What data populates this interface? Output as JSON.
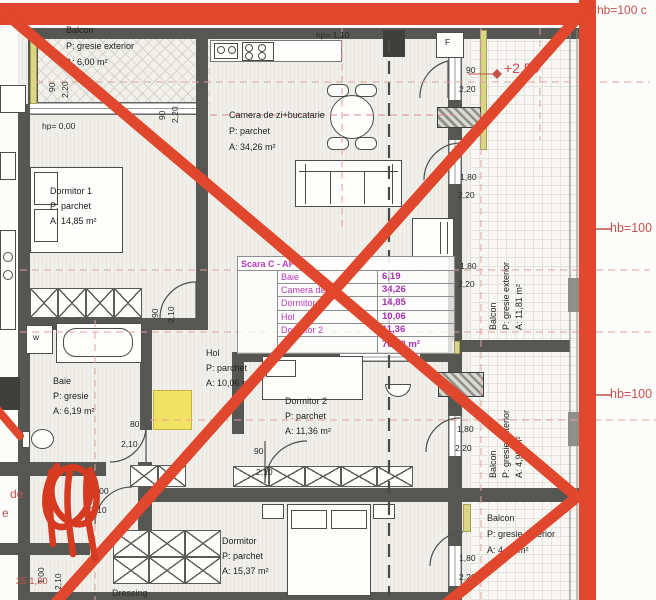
{
  "annotations": {
    "hb_top": "hb=100 c",
    "hb_mid": "hb=100",
    "hb_low": "hb=100",
    "level": "+2,50",
    "dim_red": "25  1,80",
    "frag1": "de",
    "frag2": "e"
  },
  "labels": {
    "hp_balcony": "hp= 0,00",
    "hp_kitchen": "hp= 1,10",
    "washer": "w",
    "fridge": "F",
    "dressing": "Dressing"
  },
  "rooms": {
    "balcon_tl": {
      "name": "Balcon",
      "floor": "P: gresie exterior",
      "area": "A: 6,00 m²"
    },
    "living": {
      "name": "Camera de zi+bucatarie",
      "floor": "P: parchet",
      "area": "A: 34,26 m²"
    },
    "dormitor1": {
      "name": "Dormitor 1",
      "floor": "P: parchet",
      "area": "A: 14,85 m²"
    },
    "baie": {
      "name": "Baie",
      "floor": "P: gresie",
      "area": "A: 6,19 m²"
    },
    "hol": {
      "name": "Hol",
      "floor": "P: parchet",
      "area": "A: 10,06 m²"
    },
    "dormitor2": {
      "name": "Dormitor 2",
      "floor": "P: parchet",
      "area": "A: 11,36 m²"
    },
    "dormitor_jos": {
      "name": "Dormitor",
      "floor": "P: parchet",
      "area": "A: 15,37 m²"
    },
    "balcon_dreapta": {
      "name": "Balcon",
      "floor": "P: gresie exterior",
      "area": "A: 11,81 m²"
    },
    "balcon_mijloc": {
      "name": "Balcon",
      "floor": "P: gresie exterior",
      "area": "A: 4,90 m²"
    },
    "balcon_jos": {
      "name": "Balcon",
      "floor": "P: gresie exterior",
      "area": "A: 4,47 m²"
    }
  },
  "area_table": {
    "title": "Scara C - AP",
    "rows": [
      {
        "room": "Baie",
        "area": "6,19"
      },
      {
        "room": "Camera de zi",
        "area": "34,26"
      },
      {
        "room": "Dormitor",
        "area": "14,85"
      },
      {
        "room": "Hol",
        "area": "10,06"
      },
      {
        "room": "Dormitor 2",
        "area": "11,36"
      }
    ],
    "total": "76,72 m²"
  },
  "dims": [
    "90",
    "2,20",
    "90",
    "2,20",
    "90",
    "2,20",
    "1,80",
    "2,20",
    "1,80",
    "2,20",
    "90",
    "2,10",
    "80",
    "2,10",
    "90",
    "2,10",
    "1,80",
    "2,20",
    "1,80",
    "2,20",
    "1,00",
    "2,10",
    "1,00",
    "2,10"
  ],
  "colors": {
    "annotation_red": "#e0472c",
    "drawing_red": "#c4514e",
    "table_magenta": "#b93bbd",
    "highlight_yellow": "#f2e263"
  }
}
